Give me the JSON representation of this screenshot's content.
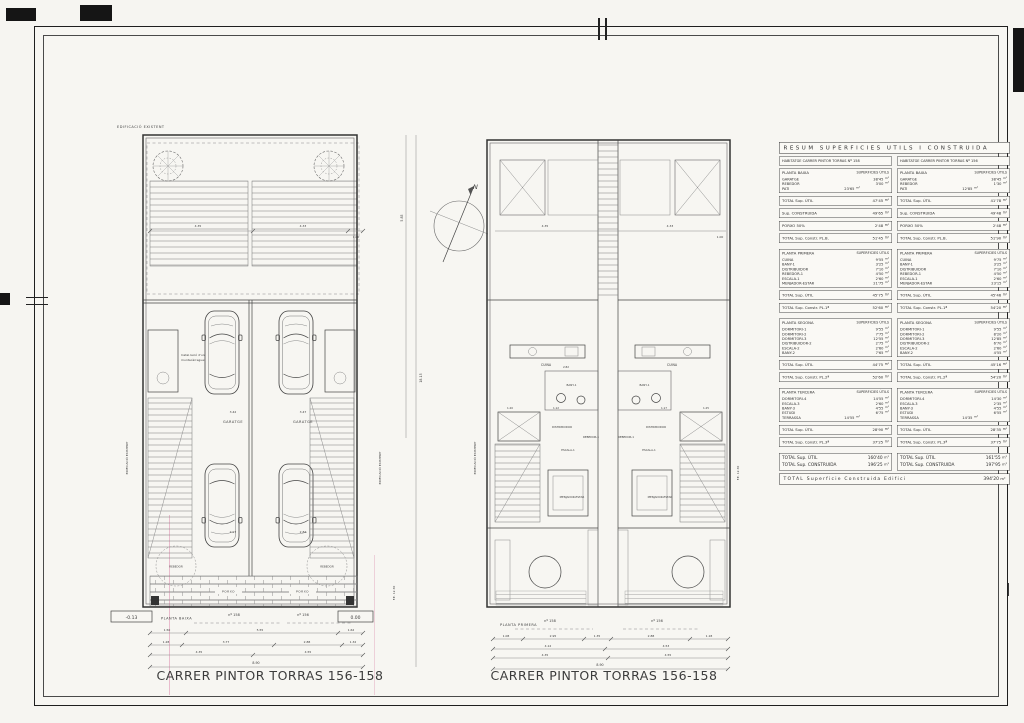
{
  "captions": {
    "left": "CARRER PINTOR TORRAS 156-158",
    "right": "CARRER PINTOR TORRAS 156-158"
  },
  "compass": {
    "label": "N"
  },
  "plans": {
    "left": {
      "title": "PLANTA BAIXA",
      "edificacio": "EDIFICACIÓ EXISTENT",
      "fe": "F.E.  12.30",
      "lift_note_1": "Instal·lació d'un",
      "lift_note_2": "muntacàrregues",
      "rooms": {
        "garatge": "GARATGE",
        "rebedor": "REBEDOR",
        "porxo": "PORXO"
      },
      "units": {
        "left": "nº 158",
        "right": "nº 156"
      },
      "elevations": {
        "left": "-0.13",
        "right": "0.00"
      },
      "side_dims": [
        "5.85",
        "18.15"
      ],
      "top_dims": [
        "4.35",
        "4.33",
        "1.00"
      ],
      "garage_dims": [
        "3.42",
        "3.47"
      ],
      "car_dims": [
        "2.97",
        "2.84"
      ],
      "dim_row1": [
        "1.50",
        "5.55",
        "1.62"
      ],
      "dim_row2": [
        "1.28",
        "3.77",
        "2.88",
        "1.32"
      ],
      "dim_row3": [
        "4.35",
        "4.55"
      ],
      "dim_total": "8.90"
    },
    "right": {
      "title": "PLANTA PRIMERA",
      "edificacio": "EDIFICACIÓ EXISTENT",
      "fe": "F.E.  12.30",
      "rooms": {
        "cuina": "CUINA",
        "bany": "BANY-1",
        "distribuidor": "DISTRIBUIDOR",
        "rebedor": "REBEDOR-1",
        "escala": "ESCALA-1",
        "menjador": "MENJADOR-ESTAR"
      },
      "units": {
        "left": "nº 158",
        "right": "nº 156"
      },
      "top_dims": [
        "4.35",
        "4.33",
        "1.00"
      ],
      "interior_dims": [
        "2.82",
        "1.20",
        "1.12",
        "1.17",
        "1.25"
      ],
      "dim_row1": [
        "1.08",
        "2.95",
        "1.35",
        "2.88",
        "1.18"
      ],
      "dim_row2": [
        "4.12",
        "4.53"
      ],
      "dim_row3": [
        "4.35",
        "4.55"
      ],
      "dim_total": "8.90"
    }
  },
  "summary_table": {
    "title": "RESUM  SUPERFICIES  UTILS  I  CONSTRUIDA",
    "unit": "m²",
    "columns": [
      {
        "blocks": [
          {
            "kind": "header",
            "text": "HABITATGE CARRER PINTOR TORRAS Nº 158"
          },
          {
            "kind": "section",
            "title": "PLANTA BAIXA",
            "subtitle": "SUPERFICIES ÚTILS",
            "rows": [
              {
                "name": "GARATGE",
                "value": "38'45"
              },
              {
                "name": "REBEDOR",
                "value": "3'00"
              },
              {
                "name": "PATI",
                "value": "23'65",
                "indent": true
              }
            ]
          },
          {
            "kind": "total",
            "label": "TOTAL Sup. ÚTIL",
            "value": "47'45"
          },
          {
            "kind": "total",
            "label": "Sup. CONSTRUIDA",
            "value": "49'65"
          },
          {
            "kind": "total",
            "label": "PORXO  50%",
            "value": "2'48"
          },
          {
            "kind": "total",
            "label": "TOTAL Sup. Constr. PL.B.",
            "value": "51'45",
            "gap_after": true
          },
          {
            "kind": "section",
            "title": "PLANTA PRIMERA",
            "subtitle": "SUPERFICIES ÚTILS",
            "rows": [
              {
                "name": "CUINA",
                "value": "9'55"
              },
              {
                "name": "BANY-1",
                "value": "3'25"
              },
              {
                "name": "DISTRIBUIDOR",
                "value": "7'10"
              },
              {
                "name": "REBEDOR-1",
                "value": "4'50"
              },
              {
                "name": "ESCALA-1",
                "value": "2'60"
              },
              {
                "name": "MENJADOR-ESTAR",
                "value": "21'75"
              }
            ]
          },
          {
            "kind": "total",
            "label": "TOTAL Sup. ÚTIL",
            "value": "45'75"
          },
          {
            "kind": "total",
            "label": "TOTAL Sup. Constr. PL.1ª",
            "value": "52'60",
            "gap_after": true
          },
          {
            "kind": "section",
            "title": "PLANTA SEGONA",
            "subtitle": "SUPERFICIES ÚTILS",
            "rows": [
              {
                "name": "DORMITORI-1",
                "value": "9'55"
              },
              {
                "name": "DORMITORI-2",
                "value": "7'75"
              },
              {
                "name": "DORMITORI-3",
                "value": "12'55"
              },
              {
                "name": "DISTRIBUIDOR-2",
                "value": "2'75"
              },
              {
                "name": "ESCALA-2",
                "value": "2'60"
              },
              {
                "name": "BANY-2",
                "value": "7'65"
              }
            ]
          },
          {
            "kind": "total",
            "label": "TOTAL Sup. ÚTIL",
            "value": "44'75"
          },
          {
            "kind": "total",
            "label": "TOTAL Sup. Constr. PL.2ª",
            "value": "52'60",
            "gap_after": true
          },
          {
            "kind": "section",
            "title": "PLANTA TERCERA",
            "subtitle": "SUPERFICIES ÚTILS",
            "rows": [
              {
                "name": "DORMITORI-4",
                "value": "14'55"
              },
              {
                "name": "ESCALA-3",
                "value": "2'60"
              },
              {
                "name": "BANY-3",
                "value": "4'55"
              },
              {
                "name": "ESTUDI",
                "value": "6'75"
              },
              {
                "name": "TERRASSA",
                "value": "14'55",
                "indent": true
              }
            ]
          },
          {
            "kind": "total",
            "label": "TOTAL Sup. ÚTIL",
            "value": "28'90"
          },
          {
            "kind": "total",
            "label": "TOTAL Sup. Constr. PL.3ª",
            "value": "37'25",
            "gap_after": true
          },
          {
            "kind": "grand",
            "rows": [
              {
                "name": "TOTAL Sup. ÚTIL",
                "value": "160'40"
              },
              {
                "name": "TOTAL Sup. CONSTRUIDA",
                "value": "196'25"
              }
            ]
          }
        ]
      },
      {
        "blocks": [
          {
            "kind": "header",
            "text": "HABITATGE CARRER PINTOR TORRAS Nº 156"
          },
          {
            "kind": "section",
            "title": "PLANTA BAIXA",
            "subtitle": "SUPERFICIES ÚTILS",
            "rows": [
              {
                "name": "GARATGE",
                "value": "38'45"
              },
              {
                "name": "REBEDOR",
                "value": "1'30"
              },
              {
                "name": "PATI",
                "value": "12'85",
                "indent": true
              }
            ]
          },
          {
            "kind": "total",
            "label": "TOTAL Sup. ÚTIL",
            "value": "41'78"
          },
          {
            "kind": "total",
            "label": "Sup. CONSTRUIDA",
            "value": "49'48"
          },
          {
            "kind": "total",
            "label": "PORXO  50%",
            "value": "2'48"
          },
          {
            "kind": "total",
            "label": "TOTAL Sup. Constr. PL.B.",
            "value": "51'90",
            "gap_after": true
          },
          {
            "kind": "section",
            "title": "PLANTA PRIMERA",
            "subtitle": "SUPERFICIES ÚTILS",
            "rows": [
              {
                "name": "CUINA",
                "value": "9'75"
              },
              {
                "name": "BANY-1",
                "value": "3'25"
              },
              {
                "name": "DISTRIBUIDOR",
                "value": "7'10"
              },
              {
                "name": "REBEDOR-1",
                "value": "4'50"
              },
              {
                "name": "ESCALA-1",
                "value": "2'60"
              },
              {
                "name": "MENJADOR-ESTAR",
                "value": "23'15"
              }
            ]
          },
          {
            "kind": "total",
            "label": "TOTAL Sup. ÚTIL",
            "value": "45'46"
          },
          {
            "kind": "total",
            "label": "TOTAL Sup. Constr. PL.1ª",
            "value": "54'20",
            "gap_after": true
          },
          {
            "kind": "section",
            "title": "PLANTA SEGONA",
            "subtitle": "SUPERFICIES ÚTILS",
            "rows": [
              {
                "name": "DORMITORI-1",
                "value": "9'55"
              },
              {
                "name": "DORMITORI-2",
                "value": "8'20"
              },
              {
                "name": "DORMITORI-3",
                "value": "12'85"
              },
              {
                "name": "DISTRIBUIDOR-2",
                "value": "6'70"
              },
              {
                "name": "ESCALA-2",
                "value": "2'60"
              },
              {
                "name": "BANY-2",
                "value": "4'55"
              }
            ]
          },
          {
            "kind": "total",
            "label": "TOTAL Sup. ÚTIL",
            "value": "45'16"
          },
          {
            "kind": "total",
            "label": "TOTAL Sup. Constr. PL.2ª",
            "value": "54'20",
            "gap_after": true
          },
          {
            "kind": "section",
            "title": "PLANTA TERCERA",
            "subtitle": "SUPERFICIES ÚTILS",
            "rows": [
              {
                "name": "DORMITORI-4",
                "value": "14'30"
              },
              {
                "name": "ESCALA-3",
                "value": "2'35"
              },
              {
                "name": "BANY-3",
                "value": "4'55"
              },
              {
                "name": "ESTUDI",
                "value": "6'55"
              },
              {
                "name": "TERRASSA",
                "value": "14'35",
                "indent": true
              }
            ]
          },
          {
            "kind": "total",
            "label": "TOTAL Sup. ÚTIL",
            "value": "28'35"
          },
          {
            "kind": "total",
            "label": "TOTAL Sup. Constr. PL.3ª",
            "value": "37'75",
            "gap_after": true
          },
          {
            "kind": "grand",
            "rows": [
              {
                "name": "TOTAL Sup. ÚTIL",
                "value": "161'55"
              },
              {
                "name": "TOTAL Sup. CONSTRUIDA",
                "value": "197'95"
              }
            ]
          }
        ]
      }
    ],
    "footer": {
      "label": "TOTAL Superficie Construida Edifici",
      "value": "394'20"
    }
  }
}
